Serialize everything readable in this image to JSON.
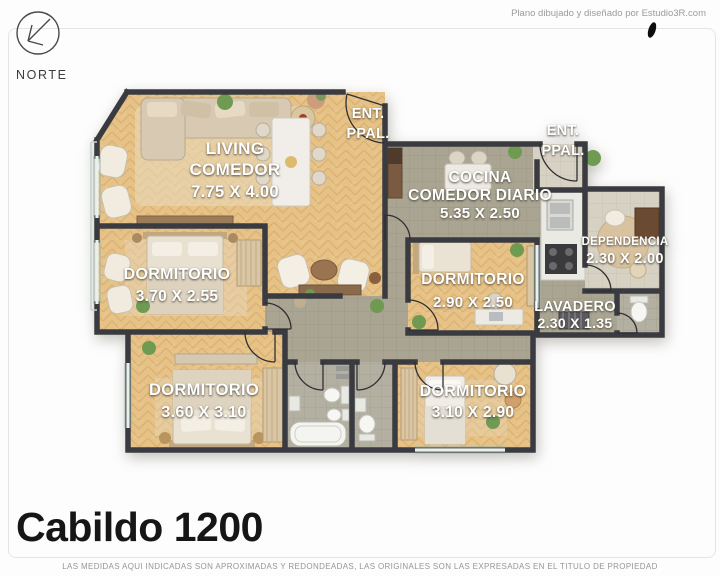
{
  "header": {
    "credit": "Plano dibujado y diseñado por Estudio3R.com",
    "compass_label": "NORTE"
  },
  "plan": {
    "entrance1": {
      "line1": "ENT.",
      "line2": "PPAL."
    },
    "entrance2": {
      "line1": "ENT.",
      "line2": "PPAL."
    },
    "rooms": {
      "living": {
        "line1": "LIVING",
        "line2": "COMEDOR",
        "dims": "7.75 X 4.00"
      },
      "cocina": {
        "line1": "COCINA",
        "line2": "COMEDOR DIARIO",
        "dims": "5.35 X 2.50"
      },
      "dormitorio1": {
        "name": "DORMITORIO",
        "dims": "3.70 X 2.55"
      },
      "dormitorio2": {
        "name": "DORMITORIO",
        "dims": "2.90 X 2.50"
      },
      "dormitorio3": {
        "name": "DORMITORIO",
        "dims": "3.60 X 3.10"
      },
      "dormitorio4": {
        "name": "DORMITORIO",
        "dims": "3.10 X 2.90"
      },
      "dependencia": {
        "name": "DEPENDENCIA",
        "dims": "2.30 X 2.00"
      },
      "lavadero": {
        "name": "LAVADERO",
        "dims": "2.30 X 1.35"
      }
    }
  },
  "footer": {
    "title": "Cabildo 1200",
    "disclaimer": "LAS MEDIDAS AQUI INDICADAS SON APROXIMADAS Y REDONDEADAS, LAS ORIGINALES SON LAS EXPRESADAS EN EL TITULO DE PROPIEDAD"
  },
  "colors": {
    "wall": "#3a3b40",
    "wood_floor": "#e6c287",
    "tile_floor": "#a9a592",
    "label_text": "#ffffff",
    "title_text": "#161616"
  }
}
